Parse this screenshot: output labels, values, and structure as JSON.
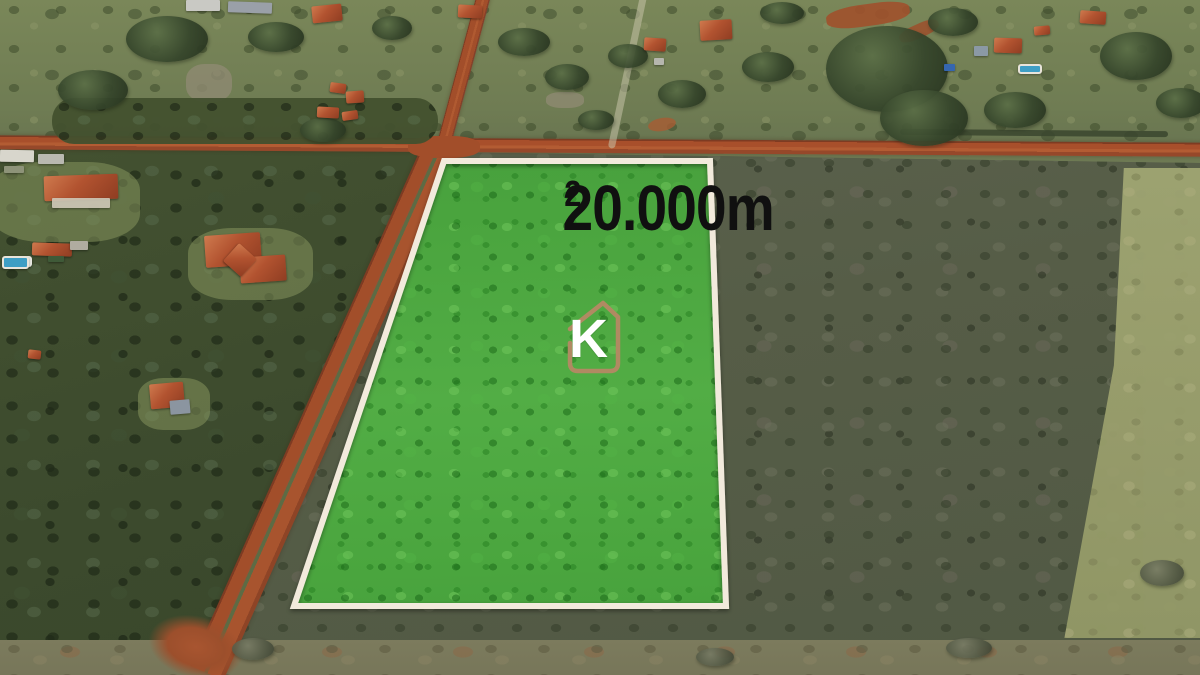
{
  "scene": {
    "description": "Aerial drone photo of rural plots: red dirt roads crossing, houses with terracotta roofs among dense cerrado vegetation, and a land parcel highlighted in green"
  },
  "overlay": {
    "area_text": "20.000m",
    "area_sup": "2",
    "area_full": "20.000m²"
  },
  "logo": {
    "letter": "K"
  },
  "colors": {
    "plot_fill": "#46a23c",
    "plot_border": "#f2eadc",
    "logo_outline": "#b08a62",
    "logo_letter": "#ffffff",
    "dirt_road": "#a24e2a",
    "label_text": "#101010"
  }
}
